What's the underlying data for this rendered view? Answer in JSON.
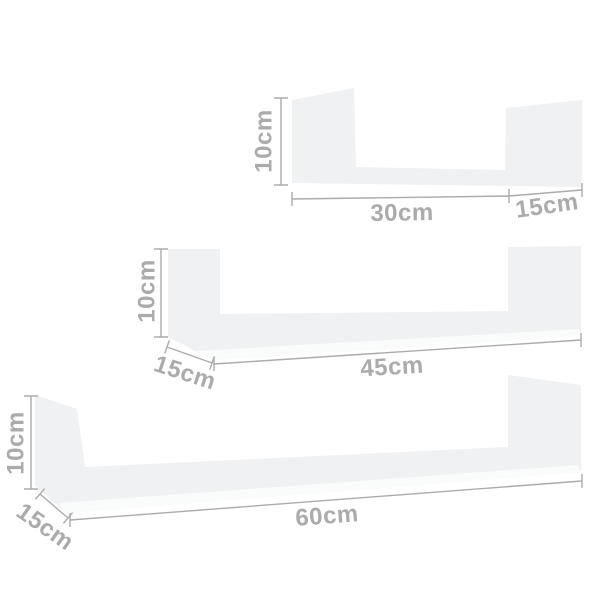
{
  "colors": {
    "background": "#ffffff",
    "shelf_body": "#f0f1f2",
    "shelf_front_edge": "#fafbfb",
    "dimension": "#ababab"
  },
  "shelves": [
    {
      "height": "10cm",
      "width": "30cm",
      "depth": "15cm"
    },
    {
      "height": "10cm",
      "width": "45cm",
      "depth": "15cm"
    },
    {
      "height": "10cm",
      "width": "60cm",
      "depth": "15cm"
    }
  ]
}
